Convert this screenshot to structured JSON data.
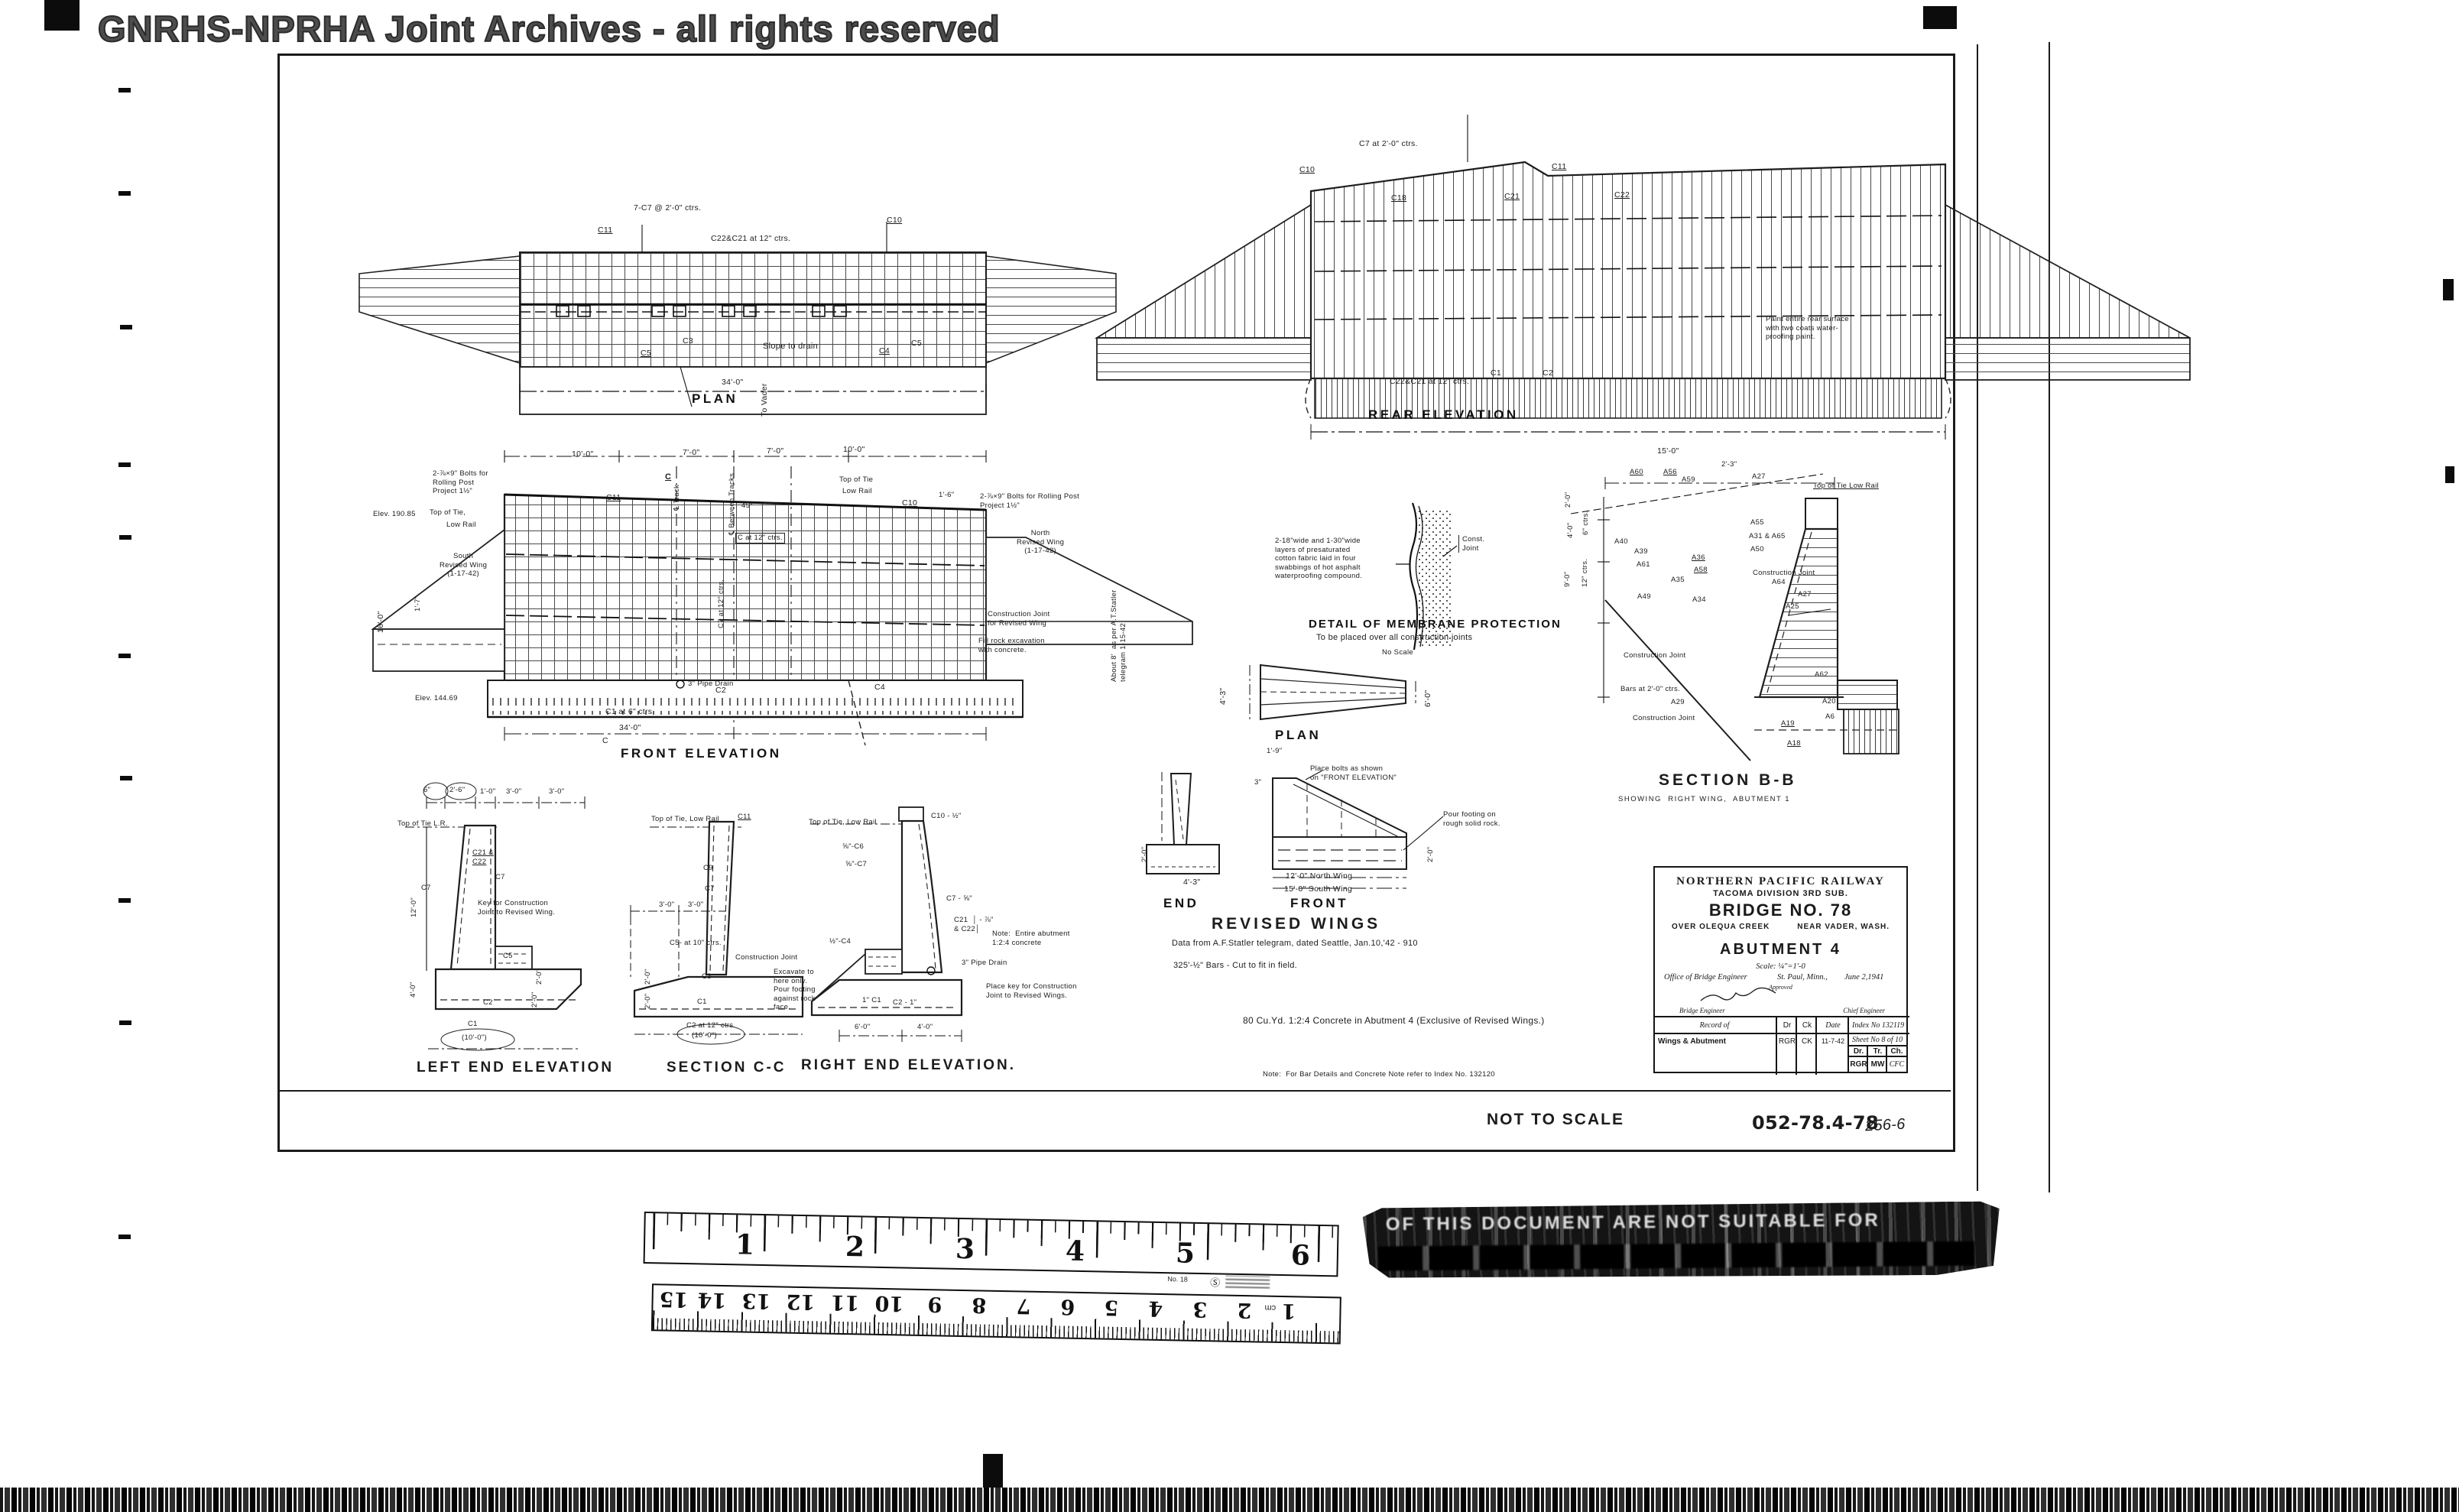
{
  "watermark": "GNRHS-NPRHA Joint Archives - all rights reserved",
  "plan": {
    "title": "PLAN",
    "bars_top": "7-C7 @ 2'-0\" ctrs.",
    "c11": "C11",
    "c10": "C10",
    "row": "C22&C21 at 12\" ctrs.",
    "c3": "C3",
    "c5a": "C5",
    "slope": "Slope to drain",
    "c4": "C4",
    "c5b": "C5",
    "dim34": "34'-0\"",
    "to_vader": "To Vader"
  },
  "rear": {
    "title": "REAR ELEVATION",
    "c7": "C7 at 2'-0\" ctrs.",
    "c10": "C10",
    "c11": "C11",
    "c18": "C18",
    "c21": "C21",
    "c22": "C22",
    "c1": "C1",
    "c2": "C2",
    "row": "C22&C21 at 12\" ctrs.",
    "paint_note": "Paint entire rear surface\nwith two coats water-\nproofing paint."
  },
  "front": {
    "title": "FRONT ELEVATION",
    "bolts_left": "2-⅞×9\" Bolts for\nRolling Post\nProject 1½\"",
    "elev_top": "Elev. 190.85",
    "top_tie": "Top of Tie,",
    "low_rail": "Low Rail",
    "south_wing": "South\nRevised Wing\n(1-17-42)",
    "dim16": "16'-0\"",
    "dim17": "1'-7\"",
    "elev_bottom": "Elev. 144.69",
    "dim10l": "10'-0\"",
    "dim7a": "7'-0\"",
    "dim7b": "7'-0\"",
    "dim10r": "10'-0\"",
    "c_marker": "C",
    "c11": "C11",
    "cl_track": "℄ Track",
    "cl_between": "℄ Between Tracks",
    "deg45": "45°",
    "c_at12": "C at 12\" ctrs.",
    "c7_at12": "C7 at 12\" ctrs.",
    "top_tie_r": "Top of Tie",
    "low_rail_r": "Low Rail",
    "c10": "C10",
    "dim16r": "1'-6\"",
    "bolts_right": "2-⅞×9\" Bolts for Rolling Post\nProject 1½\"",
    "north_wing": "North\nRevised Wing\n(1-17-42)",
    "cj_wing": "Construction Joint\nfor Revised Wing",
    "fill_rock": "Fill rock excavation\nwith concrete.",
    "statler": "About 8'  as per A.T.Statler\ntelegram 1-15-42",
    "pipe_drain": "3\" Pipe Drain",
    "c2": "C2",
    "c4": "C4",
    "c1_row": "C1 at 6\" ctrs.",
    "dim34": "34'-0\"",
    "c_bottom": "C"
  },
  "membrane": {
    "note": "2-18\"wide and 1-30\"wide\nlayers of presaturated\ncotton fabric laid in four\nswabbings of hot asphalt\nwaterproofing compound.",
    "const_joint": "Const.\nJoint",
    "title": "DETAIL OF MEMBRANE PROTECTION",
    "subtitle": "To be placed over all construction joints",
    "scale": "No Scale"
  },
  "revised_wings": {
    "plan_title": "PLAN",
    "dim43_end": "4'-3\"",
    "dim60": "6'-0\"",
    "dim19": "1'-9\"",
    "dim3": "3\"",
    "place_bolts": "Place bolts as shown\non \"FRONT ELEVATION\"",
    "pour_footing": "Pour footing on\nrough solid rock.",
    "dim20l": "2'-0\"",
    "dim20r": "2'-0\"",
    "dim43b": "4'-3\"",
    "north": "12'-0\" North Wing",
    "south": "15'-0\" South Wing",
    "end_title": "END",
    "front_title": "FRONT",
    "title": "REVISED WINGS",
    "data_note": "Data from A.F.Statler telegram, dated Seattle, Jan.10,'42 - 910",
    "bars_note": "325'-½\" Bars - Cut to fit in field."
  },
  "section_bb": {
    "title": "SECTION B-B",
    "subtitle": "SHOWING  RIGHT WING,  ABUTMENT 1",
    "dim15": "15'-0\"",
    "dim23": "2'-3\"",
    "dim20": "2'-0\"",
    "dim40": "4'-0\"",
    "dim90": "9'-0\"",
    "ctrs6": "6\" ctrs.",
    "ctrs12": "12\" ctrs.",
    "a60": "A60",
    "a56": "A56",
    "a59": "A59",
    "a27": "A27",
    "top_tie": "Top of Tie Low Rail",
    "a55": "A55",
    "a31": "A31 & A65",
    "a50": "A50",
    "a40": "A40",
    "a39": "A39",
    "a61": "A61",
    "a58": "A58",
    "a36": "A36",
    "a35": "A35",
    "a49": "A49",
    "a34": "A34",
    "cj1": "Construction Joint",
    "a64": "A64",
    "a27b": "A27",
    "a25": "A25",
    "cj2": "Construction Joint",
    "bars20": "Bars at 2'-0\" ctrs.",
    "a29": "A29",
    "cj3": "Construction Joint",
    "a62": "A62",
    "a20": "A20",
    "a6": "A6",
    "a19": "A19",
    "a18": "A18"
  },
  "left_end": {
    "title": "LEFT END ELEVATION",
    "top_tie": "Top of Tie L.R.",
    "d6": "6\"",
    "d26": "2'-6\"",
    "d10": "1'-0\"",
    "d30a": "3'-0\"",
    "d30b": "3'-0\"",
    "c21": "C21 &\nC22",
    "c7a": "C7",
    "c7b": "C7",
    "dim12": "12'-0\"",
    "key_note": "Key for Construction\nJoint to Revised Wing.",
    "c5": "C5",
    "dim40": "4'-0\"",
    "dim20a": "2'-0\"",
    "dim20b": "2'-0\"",
    "c2": "C2",
    "c1": "C1",
    "dim10": "(10'-0\")"
  },
  "section_cc": {
    "title": "SECTION C-C",
    "top_tie": "Top of Tie, Low Rail",
    "c11": "C11",
    "c9": "C9",
    "c7": "C7",
    "dims": "3'-0\"      3'-0\"",
    "c5": "C5- at 10\" ctrs.",
    "c3": "C3",
    "dim20a": "2'-0\"",
    "dim20b": "2'-0\"",
    "c1": "C1",
    "c2row": "C2 at 12\" ctrs.",
    "dim10": "(10'-0\")"
  },
  "right_end": {
    "title": "RIGHT END ELEVATION.",
    "top_tie": "Top of Tie, Low Rail",
    "c10": "C10 - ½\"",
    "c6": "⅝\"-C6",
    "c7": "⅝\"-C7",
    "c7b": "C7 - ⅝\"",
    "c21": "C21  │ - ⅞\"\n& C22│",
    "note": "Note:  Entire abutment\n1:2:4 concrete",
    "c4": "½\"-C4",
    "cj": "Construction Joint",
    "excavate": "Excavate to\nhere only.\nPour footing\nagainst rock\nface.",
    "drain": "3\" Pipe Drain",
    "key": "Place key for Construction\nJoint to Revised Wings.",
    "c1": "1\" C1",
    "c2": "C2 - 1\"",
    "dim6": "6'-0\"",
    "dim4": "4'-0\""
  },
  "notes": {
    "concrete": "80 Cu.Yd. 1:2:4 Concrete in Abutment 4 (Exclusive of Revised Wings.)",
    "refer": "Note:  For Bar Details and Concrete Note refer to Index No. 132120"
  },
  "title_block": {
    "railway": "NORTHERN PACIFIC RAILWAY",
    "division": "TACOMA    DIVISION    3RD SUB.",
    "bridge": "BRIDGE  NO.  78",
    "over": "OVER  OLEQUA  CREEK",
    "near": "NEAR  VADER, WASH.",
    "abutment": "ABUTMENT 4",
    "scale": "Scale: ¼\"=1'-0",
    "office": "Office  of  Bridge  Engineer",
    "city": "St. Paul, Minn.,",
    "date": "June 2,1941",
    "approved": "Approved",
    "bridge_engineer": "Bridge  Engineer",
    "chief_engineer": "Chief  Engineer",
    "record_header": "Record  of",
    "col_d": "Dr",
    "col_c": "Ck",
    "col_date": "Date",
    "index": "Index  No 132119",
    "revision": "Wings & Abutment",
    "rev_d": "RGR",
    "rev_ck": "CK",
    "rev_date": "11-7-42",
    "sheet": "Sheet  No  8  of  10",
    "dr": "Dr.",
    "tr": "Tr.",
    "ch": "Ch.",
    "dr_v": "RGR",
    "tr_v": "MW",
    "ch_v": "CFC"
  },
  "footer": {
    "not_to_scale": "NOT TO SCALE",
    "doc_number": "052-78.4-78",
    "doc_number_hand": "256-6"
  },
  "ruler": {
    "inches": [
      "1",
      "2",
      "3",
      "4",
      "5",
      "6"
    ],
    "no18": "No. 18",
    "cm": [
      "1",
      "2",
      "3",
      "4",
      "5",
      "6",
      "7",
      "8",
      "9",
      "10",
      "11",
      "12",
      "13",
      "14",
      "15"
    ],
    "cm_unit": "cm"
  },
  "stamp": {
    "line1": "OF THIS DOCUMENT ARE NOT SUITABLE FOR"
  }
}
